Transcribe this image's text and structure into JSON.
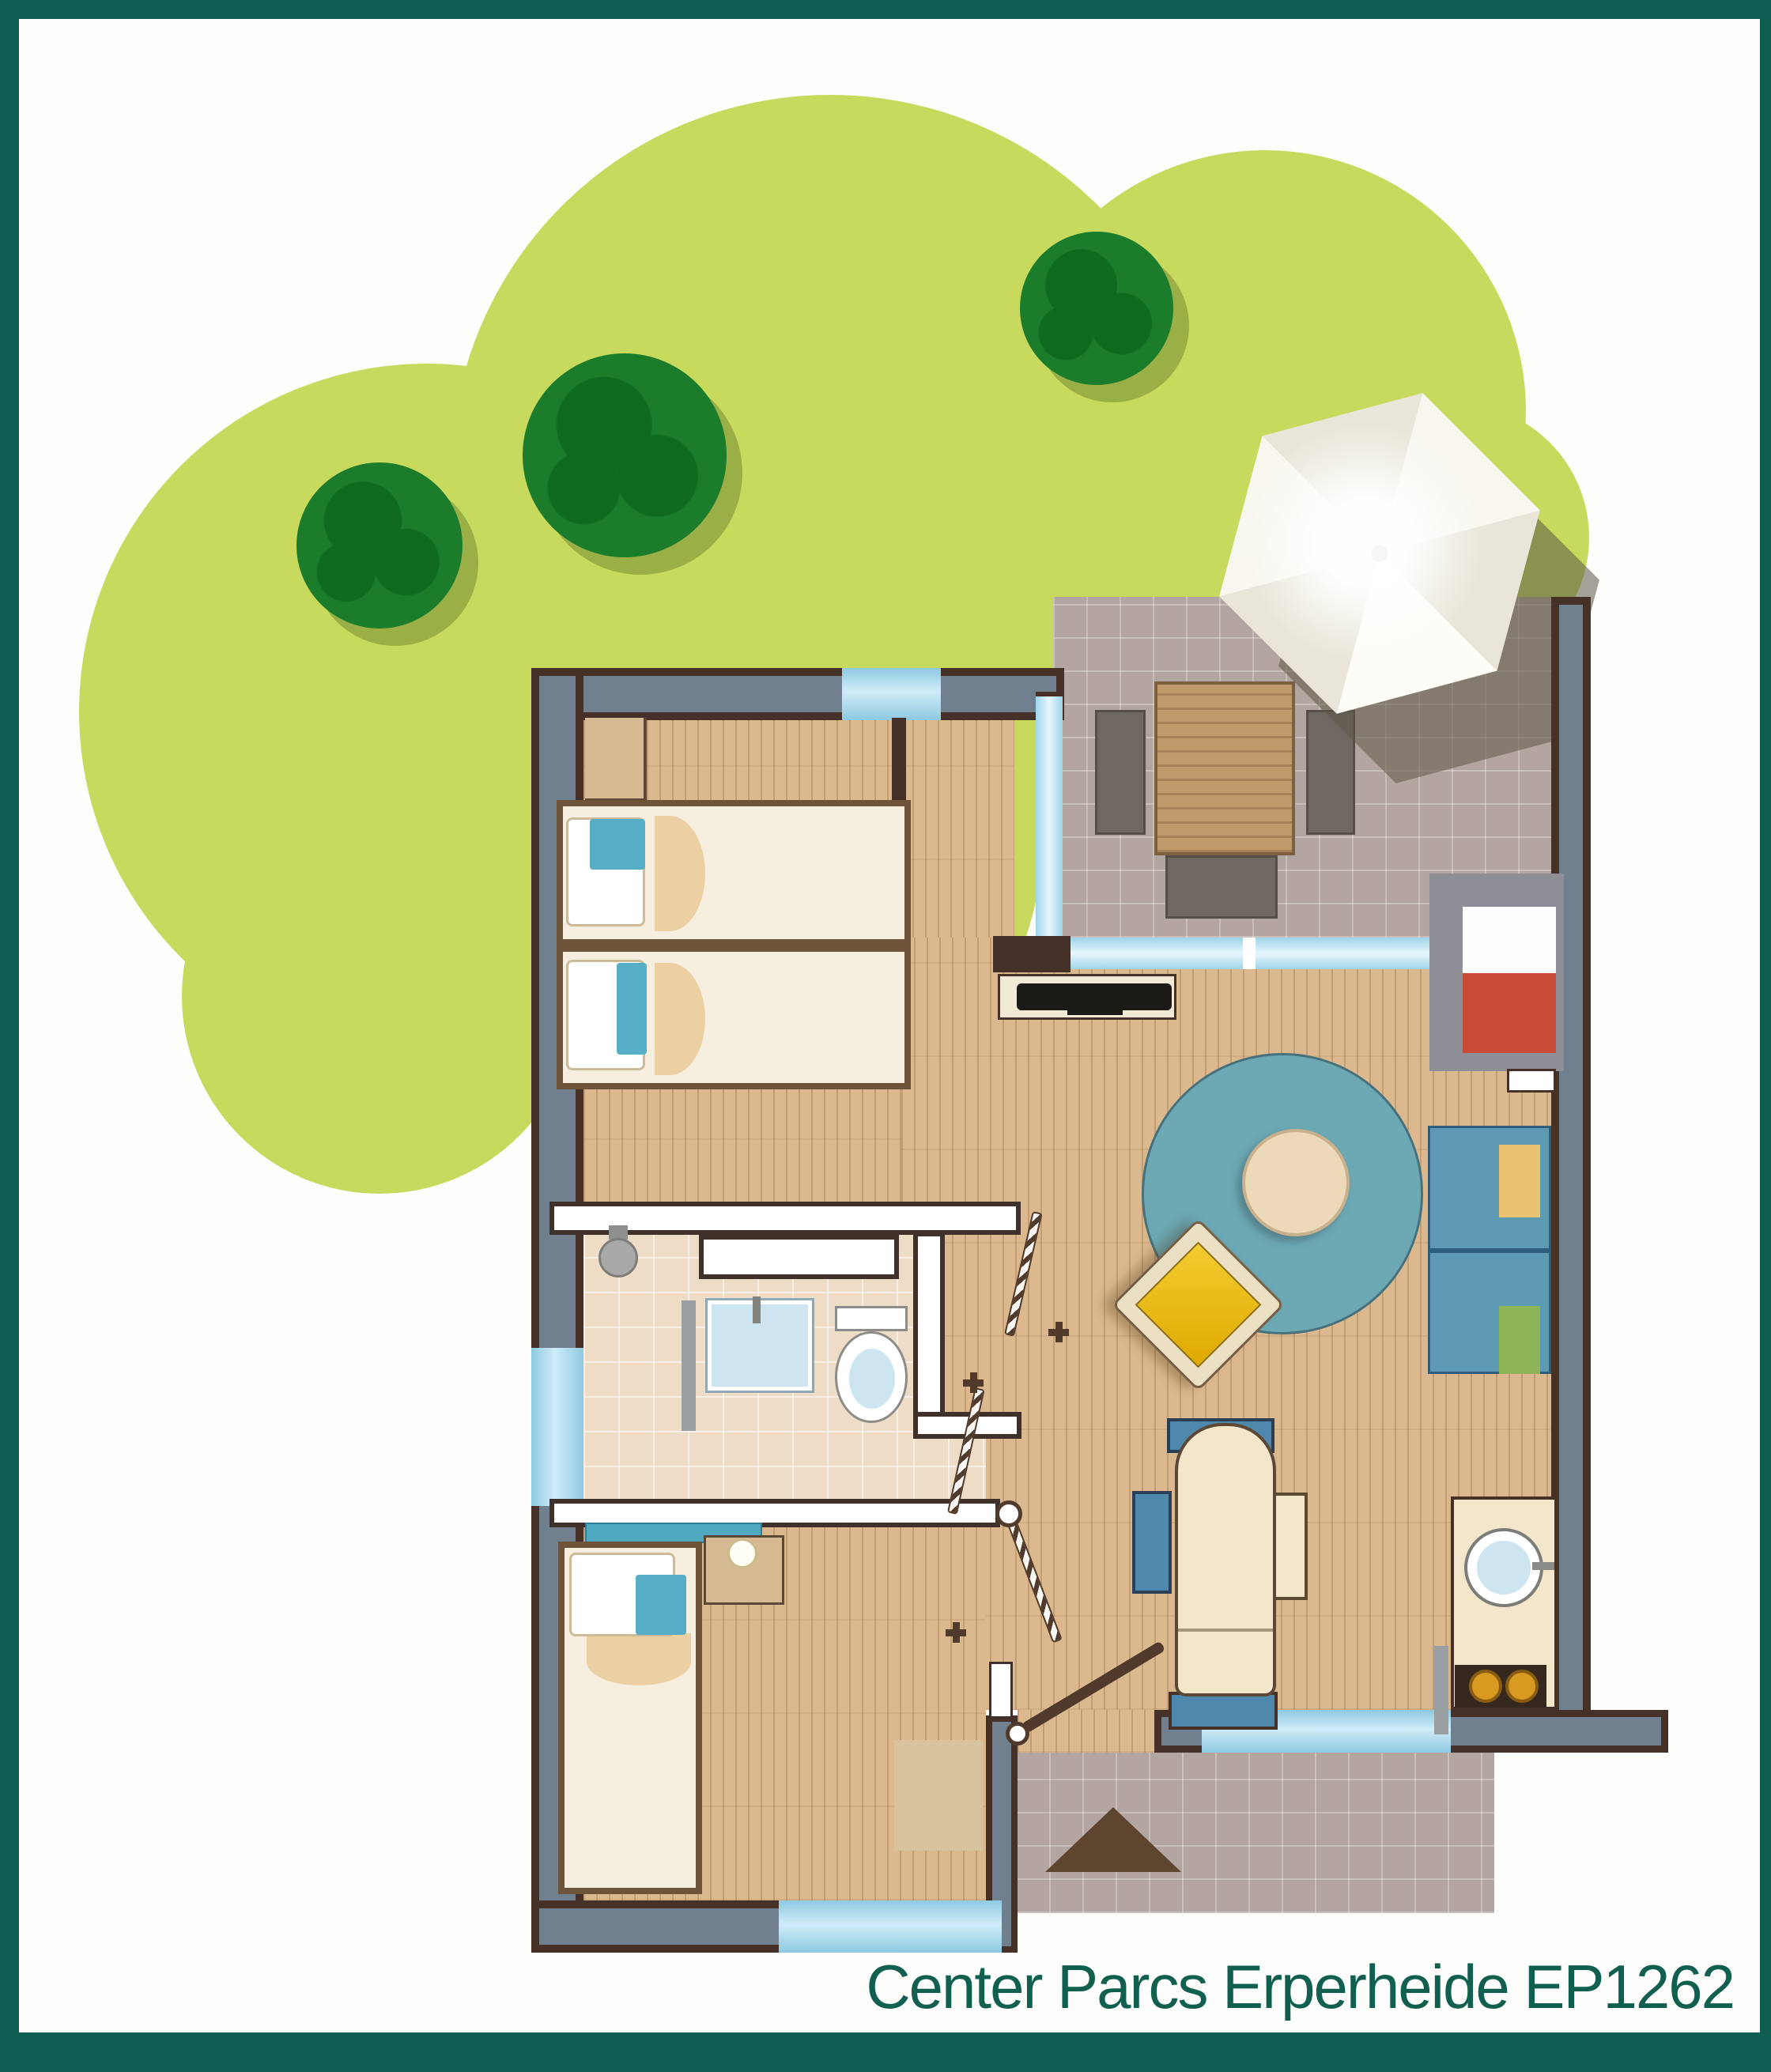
{
  "caption": {
    "text": "Center Parcs Erperheide EP1262"
  },
  "palette": {
    "frame": "#0d5d51",
    "paper": "#fdfdfc",
    "grass": "#c8da5e",
    "tree": "#1b7d2c",
    "treeDark": "#0e6a1f",
    "treeShadow": "rgba(70,95,25,0.35)",
    "wallFill": "#71808e",
    "wallDark": "#463129",
    "iwallEdge": "#40302a",
    "window": "#aadcf0",
    "wood": "#dcb88e",
    "woodLine": "rgba(130,90,45,0.28)",
    "woodKnot": "rgba(130,90,45,0.12)",
    "tile": "#b3a6a1",
    "tileLine": "rgba(255,255,255,0.28)",
    "bathTile": "#eedcc6",
    "mattress": "#f6efe0",
    "pillowTeal": "#55aec5",
    "blanket": "#ecd0a4",
    "bedFrame": "#6d5339",
    "closet": "#d6ba94",
    "rug": "#6ca9b5",
    "rugEdge": "#47727c",
    "coffeeTable": "#ecd9ba",
    "chairYellowA": "#f3cc2f",
    "chairYellowB": "#dfa900",
    "chairCream": "#ece0c4",
    "sofaBlue": "#5e9ab4",
    "sofaEdge": "#2e5e7e",
    "cushionYellow": "#e9c272",
    "cushionGreen": "#8db558",
    "niche": "#8e8e96",
    "seatRed": "#c94a37",
    "tv": "#1c1a17",
    "sideboard": "#f3ead6",
    "diningTable": "#f3e6cb",
    "diningChairBlue": "#4f88ad",
    "counter": "#f3e6cb",
    "sinkBlue": "#cde4f1",
    "stove": "#35291f",
    "burner": "#d99a22",
    "outTable": "#c09a6b",
    "outChair": "#6f6761",
    "parasolA": "#f8f6ef",
    "parasolB": "#e9e6d9",
    "parasolShadow": "rgba(92,85,70,0.55)",
    "doorDark": "#503a2b",
    "pathTriangle": "#5e4530",
    "teal_shelf": "#4fa9c1",
    "caption": "#11604f"
  }
}
